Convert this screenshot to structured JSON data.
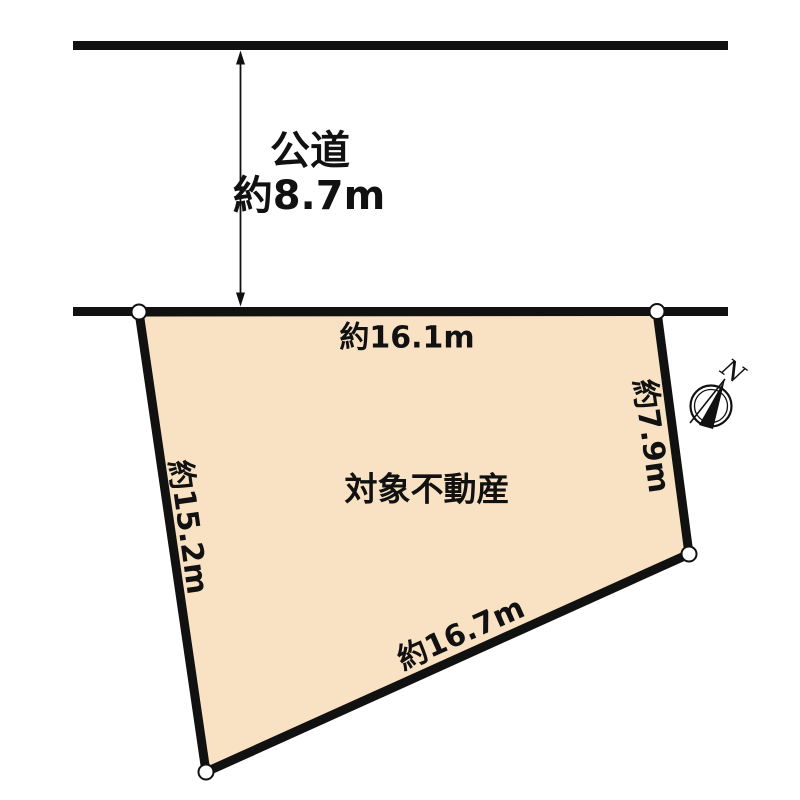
{
  "road": {
    "name": "公道",
    "width": "約8.7m"
  },
  "parcel": {
    "label": "対象不動産",
    "fill_color": "#F8E2C3",
    "dimensions": {
      "top": "約16.1m",
      "right": "約7.9m",
      "bottom": "約16.7m",
      "left": "約15.2m"
    }
  },
  "compass": {
    "north": "N"
  },
  "colors": {
    "line": "#111111",
    "text": "#111111"
  }
}
